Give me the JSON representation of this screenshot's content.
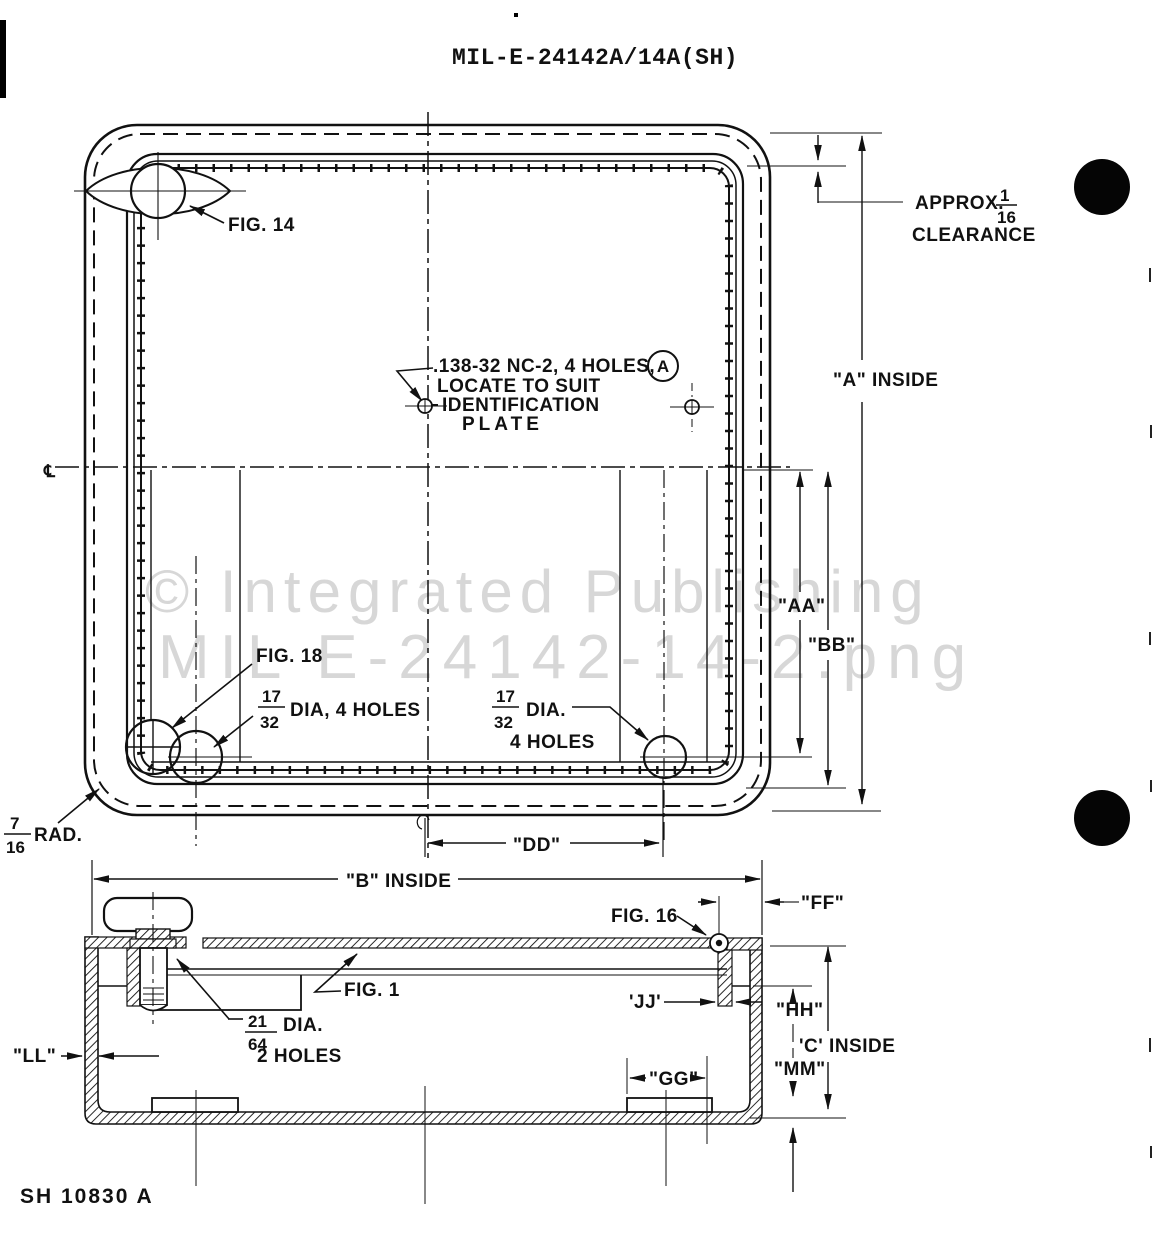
{
  "title": "MIL-E-24142A/14A(SH)",
  "sheet_id": "SH 10830 A",
  "watermark": {
    "line1": "© Integrated Publishing",
    "line2": "MIL E-24142-14-2.png"
  },
  "colors": {
    "ink": "#111111",
    "watermark": "#d7d7d7",
    "paper": "#ffffff"
  },
  "plan_view": {
    "fig14": "FIG. 14",
    "fig18": "FIG. 18",
    "note": {
      "line1": ".138-32 NC-2, 4 HOLES,",
      "callout": "A",
      "line2": "LOCATE TO SUIT",
      "line3": "IDENTIFICATION",
      "line4": "PLATE"
    },
    "clearance": {
      "prefix": "APPROX.",
      "num": "1",
      "den": "16",
      "word": "CLEARANCE"
    },
    "corner_radius": {
      "num": "7",
      "den": "16",
      "suffix": "RAD."
    },
    "hole_left": {
      "num": "17",
      "den": "32",
      "suffix": "DIA, 4 HOLES"
    },
    "hole_right": {
      "num": "17",
      "den": "32",
      "line1": "DIA.",
      "line2": "4 HOLES"
    },
    "dims": {
      "a": "\"A\" INSIDE",
      "aa": "\"AA\"",
      "bb": "\"BB\"",
      "dd": "\"DD\""
    },
    "centerline": "℄"
  },
  "section_view": {
    "fig16": "FIG. 16",
    "fig1": "FIG. 1",
    "bolt_hole": {
      "num": "21",
      "den": "64",
      "line1": "DIA.",
      "line2": "2 HOLES"
    },
    "dims": {
      "b": "\"B\" INSIDE",
      "ff": "\"FF\"",
      "jj": "'JJ'",
      "hh": "\"HH\"",
      "c": "'C' INSIDE",
      "mm": "\"MM\"",
      "gg": "\"GG\"",
      "ll": "\"LL\""
    }
  }
}
